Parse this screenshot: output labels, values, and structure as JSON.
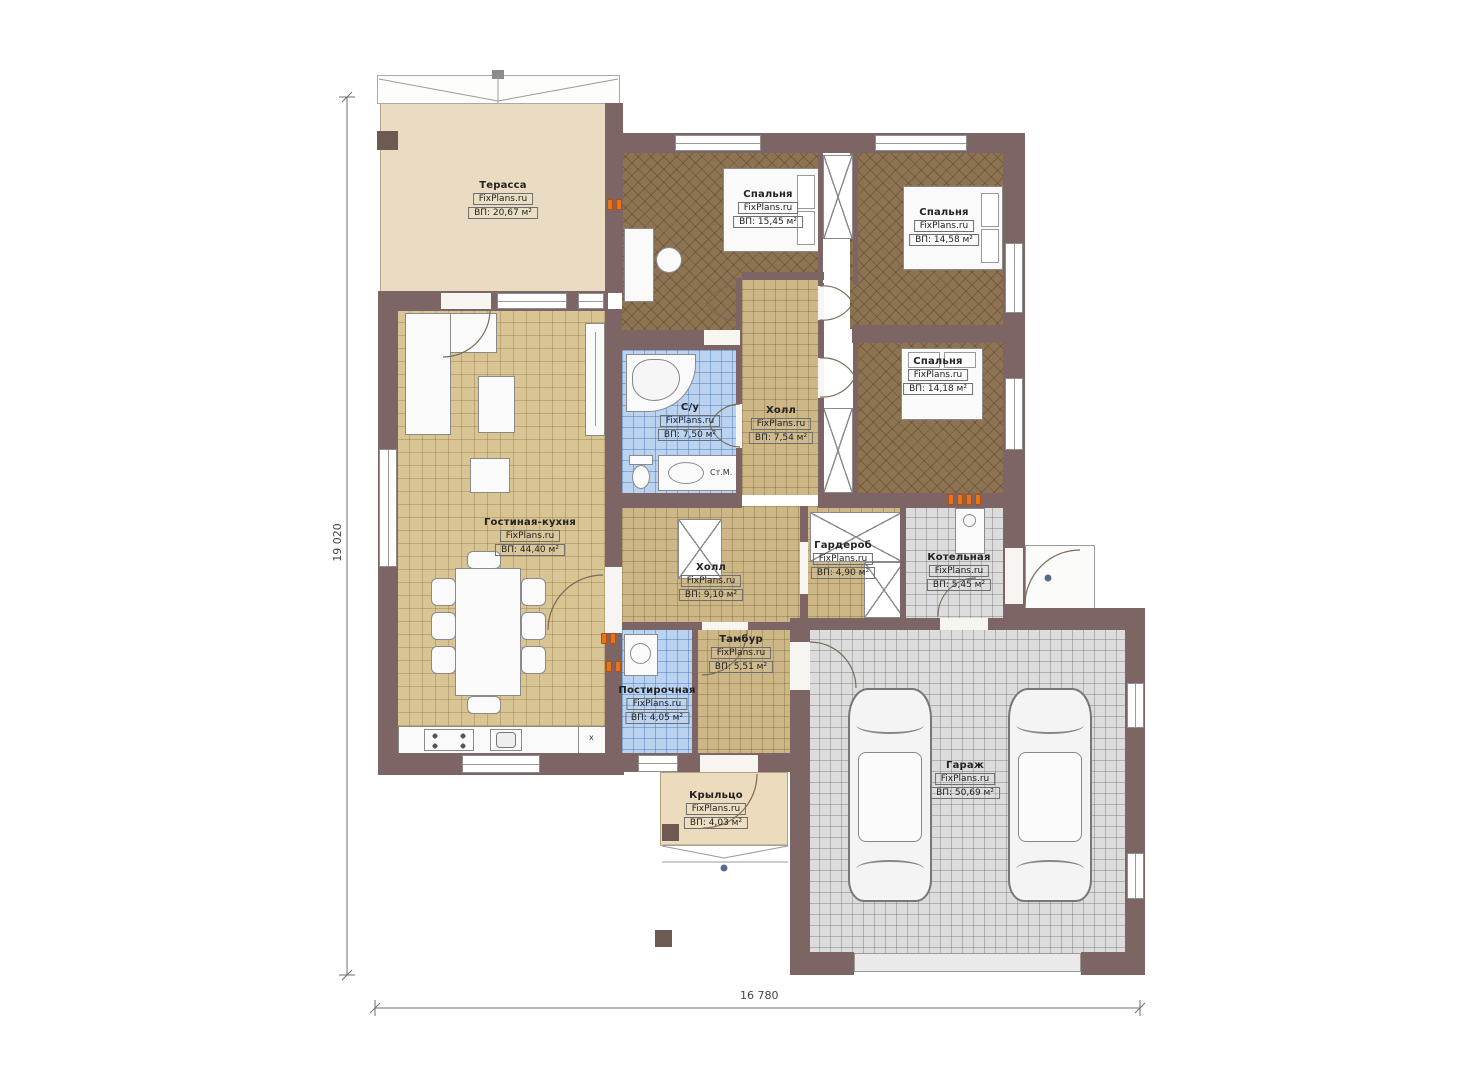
{
  "plan": {
    "title": "Одноэтажный дом — план этажа",
    "brand": "FixPlans.ru",
    "dimensions": {
      "height_label": "19 020",
      "width_label": "16 780"
    },
    "rooms": [
      {
        "id": "terrace",
        "name": "Терасса",
        "brand": "FixPlans.ru",
        "area": "ВП: 20,67 м²"
      },
      {
        "id": "bedroom-1",
        "name": "Спальня",
        "brand": "FixPlans.ru",
        "area": "ВП: 15,45 м²"
      },
      {
        "id": "bedroom-2",
        "name": "Спальня",
        "brand": "FixPlans.ru",
        "area": "ВП: 14,58 м²"
      },
      {
        "id": "bedroom-3",
        "name": "Спальня",
        "brand": "FixPlans.ru",
        "area": "ВП: 14,18 м²"
      },
      {
        "id": "bathroom",
        "name": "С/у",
        "brand": "FixPlans.ru",
        "area": "ВП: 7,50 м²"
      },
      {
        "id": "hall-upper",
        "name": "Холл",
        "brand": "FixPlans.ru",
        "area": "ВП: 7,54 м²"
      },
      {
        "id": "living-kitchen",
        "name": "Гостиная-кухня",
        "brand": "FixPlans.ru",
        "area": "ВП: 44,40 м²"
      },
      {
        "id": "hall-lower",
        "name": "Холл",
        "brand": "FixPlans.ru",
        "area": "ВП: 9,10 м²"
      },
      {
        "id": "wardrobe",
        "name": "Гардероб",
        "brand": "FixPlans.ru",
        "area": "ВП: 4,90 м²"
      },
      {
        "id": "boiler-room",
        "name": "Котельная",
        "brand": "FixPlans.ru",
        "area": "ВП: 5,45 м²"
      },
      {
        "id": "tambour",
        "name": "Тамбур",
        "brand": "FixPlans.ru",
        "area": "ВП: 5,51 м²"
      },
      {
        "id": "laundry",
        "name": "Постирочная",
        "brand": "FixPlans.ru",
        "area": "ВП: 4,05 м²"
      },
      {
        "id": "porch",
        "name": "Крыльцо",
        "brand": "FixPlans.ru",
        "area": "ВП: 4,03 м²"
      },
      {
        "id": "garage",
        "name": "Гараж",
        "brand": "FixPlans.ru",
        "area": "ВП: 50,69 м²"
      }
    ],
    "annotations": {
      "washing_machine": "Ст.М.",
      "kitchen_unit": "x"
    },
    "colors": {
      "wall": "#7d6565",
      "terrace_floor": "#e9dcc2",
      "living_floor": "#d9c493",
      "hall_floor": "#cdb787",
      "bedroom_floor": "#8d7351",
      "bath_floor": "#b9d3f0",
      "garage_floor": "#dcdcdc",
      "porch_floor": "#ecdcbd",
      "radiator_marker": "#e8731e"
    }
  }
}
